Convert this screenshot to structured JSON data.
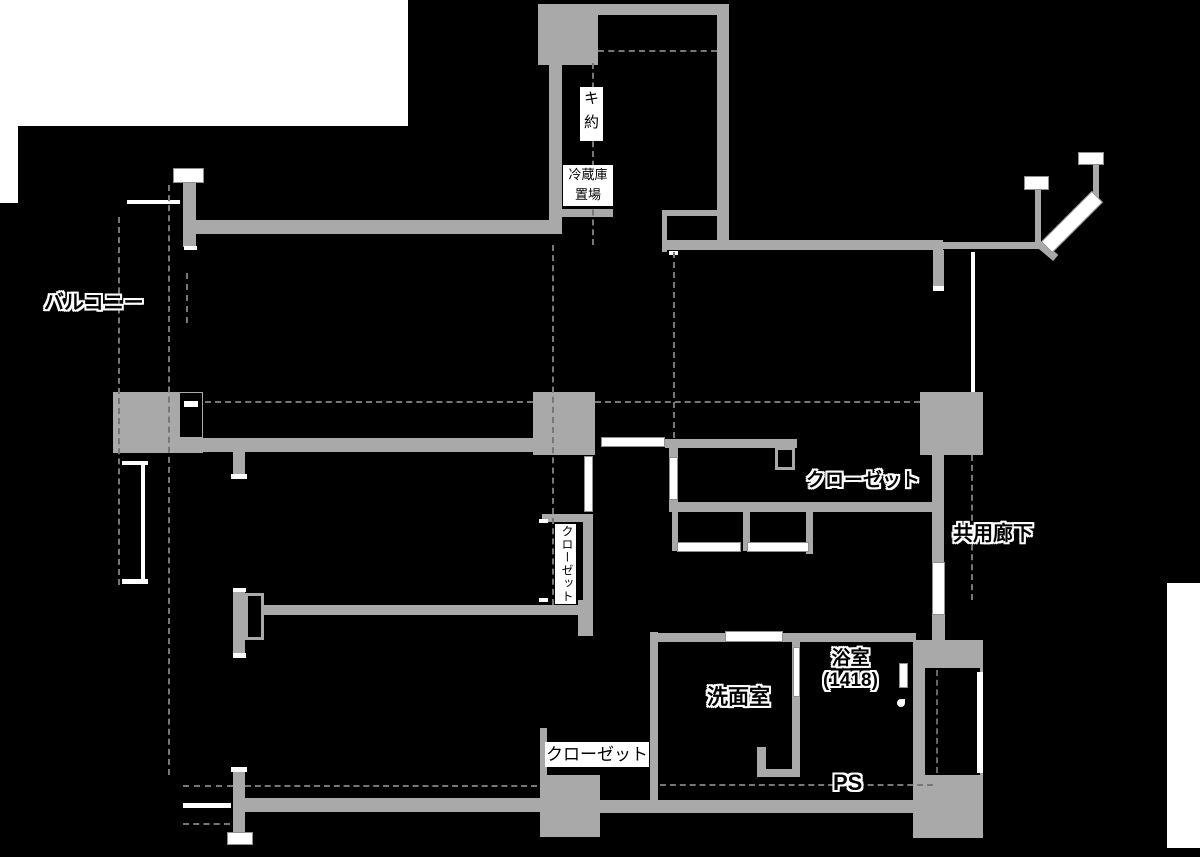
{
  "title": "マンション間取り図（部分マスク）",
  "colors": {
    "paper": "#ffffff",
    "mask": "#000000",
    "wall": "#a9a9a9",
    "dash": "#777777",
    "door_white": "#ffffff"
  },
  "labels": {
    "balcony": "バルコニー",
    "kitchen_partial_top": "キ",
    "kitchen_partial_bottom": "約",
    "fridge_line1": "冷蔵庫",
    "fridge_line2": "置場",
    "closet_upper": "クローゼット",
    "common_corridor": "共用廊下",
    "closet_middle_vertical": "クローゼット",
    "washroom": "洗面室",
    "bathroom_name": "浴室",
    "bathroom_size": "(1418)",
    "closet_bottom": "クローゼット",
    "pipe_space": "PS"
  }
}
